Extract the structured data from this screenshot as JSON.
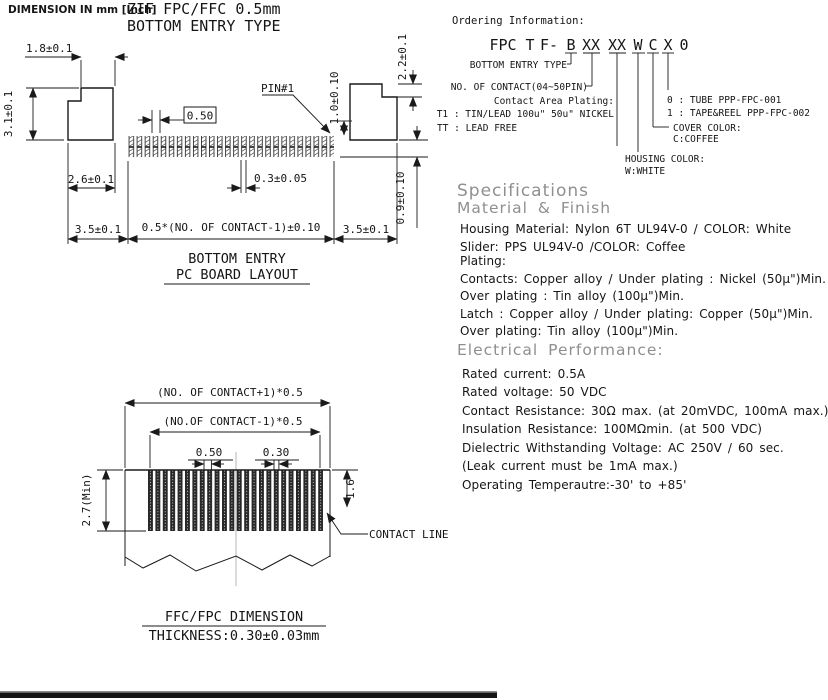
{
  "page": {
    "dimension_note": "DIMENSION IN mm [Inch]",
    "title_line1": "ZIF FPC/FFC 0.5mm",
    "title_line2": "BOTTOM ENTRY TYPE"
  },
  "pcb": {
    "caption1": "BOTTOM ENTRY",
    "caption2": "PC BOARD LAYOUT",
    "dim_18": "1.8±0.1",
    "dim_31": "3.1±0.1",
    "dim_26": "2.6±0.1",
    "dim_35_left": "3.5±0.1",
    "dim_35_right": "3.5±0.1",
    "dim_pitch": "0.50",
    "dim_pad": "0.3±0.05",
    "dim_span": "0.5*(NO. OF CONTACT-1)±0.10",
    "dim_10": "1.0±0.10",
    "dim_22": "2.2±0.1",
    "dim_09": "0.9±0.10",
    "pin1": "PIN#1"
  },
  "ffc": {
    "caption1": "FFC/FPC DIMENSION",
    "caption2": "THICKNESS:0.30±0.03mm",
    "dim_outer": "(NO. OF CONTACT+1)*0.5",
    "dim_inner": "(NO.OF CONTACT-1)*0.5",
    "dim_pitch": "0.50",
    "dim_pad": "0.30",
    "dim_height": "2.7(Min)",
    "dim_contact": "1.6",
    "contact_line": "CONTACT LINE"
  },
  "ordering": {
    "heading": "Ordering Information:",
    "code": [
      "FPC",
      "T",
      "F-",
      "B",
      "XX",
      "XX",
      "W",
      "C",
      "X",
      "0"
    ],
    "bottom_entry": "BOTTOM ENTRY TYPE",
    "contacts": "NO. OF CONTACT(04~50PIN)",
    "plating_label": "Contact Area Plating:",
    "plating_t1": "T1 : TIN/LEAD 100u\" 50u\" NICKEL",
    "plating_tt": "TT : LEAD FREE",
    "pack_0": "0 : TUBE PPP-FPC-001",
    "pack_1": "1 : TAPE&REEL PPP-FPC-002",
    "cover_label": "COVER COLOR:",
    "cover_value": "C:COFFEE",
    "housing_label": "HOUSING COLOR:",
    "housing_value": "W:WHITE"
  },
  "specs": {
    "heading": "Specifications",
    "material_heading": "Material & Finish",
    "material_lines": [
      "Housing Material: Nylon 6T UL94V-0 / COLOR: White",
      "Slider: PPS UL94V-0 /COLOR: Coffee",
      "Plating:",
      "Contacts: Copper alloy / Under plating : Nickel (50μ\")Min.",
      "Over plating : Tin alloy  (100μ\")Min.",
      "Latch : Copper alloy / Under plating: Copper  (50μ\")Min.",
      "Over plating: Tin alloy  (100μ\")Min."
    ],
    "electrical_heading": "Electrical Performance:",
    "electrical_lines": [
      "Rated current: 0.5A",
      "Rated voltage: 50 VDC",
      "Contact Resistance: 30Ω max. (at 20mVDC, 100mA max.)",
      "Insulation Resistance: 100MΩmin. (at 500 VDC)",
      "Dielectric Withstanding Voltage: AC 250V / 60 sec.",
      "(Leak current must be 1mA max.)",
      "Operating Temperautre:-30' to +85'"
    ]
  },
  "colors": {
    "ink": "#1a1a1a",
    "heading_gray": "#8f8f8f",
    "centerline_gray": "#b4b4b4"
  }
}
